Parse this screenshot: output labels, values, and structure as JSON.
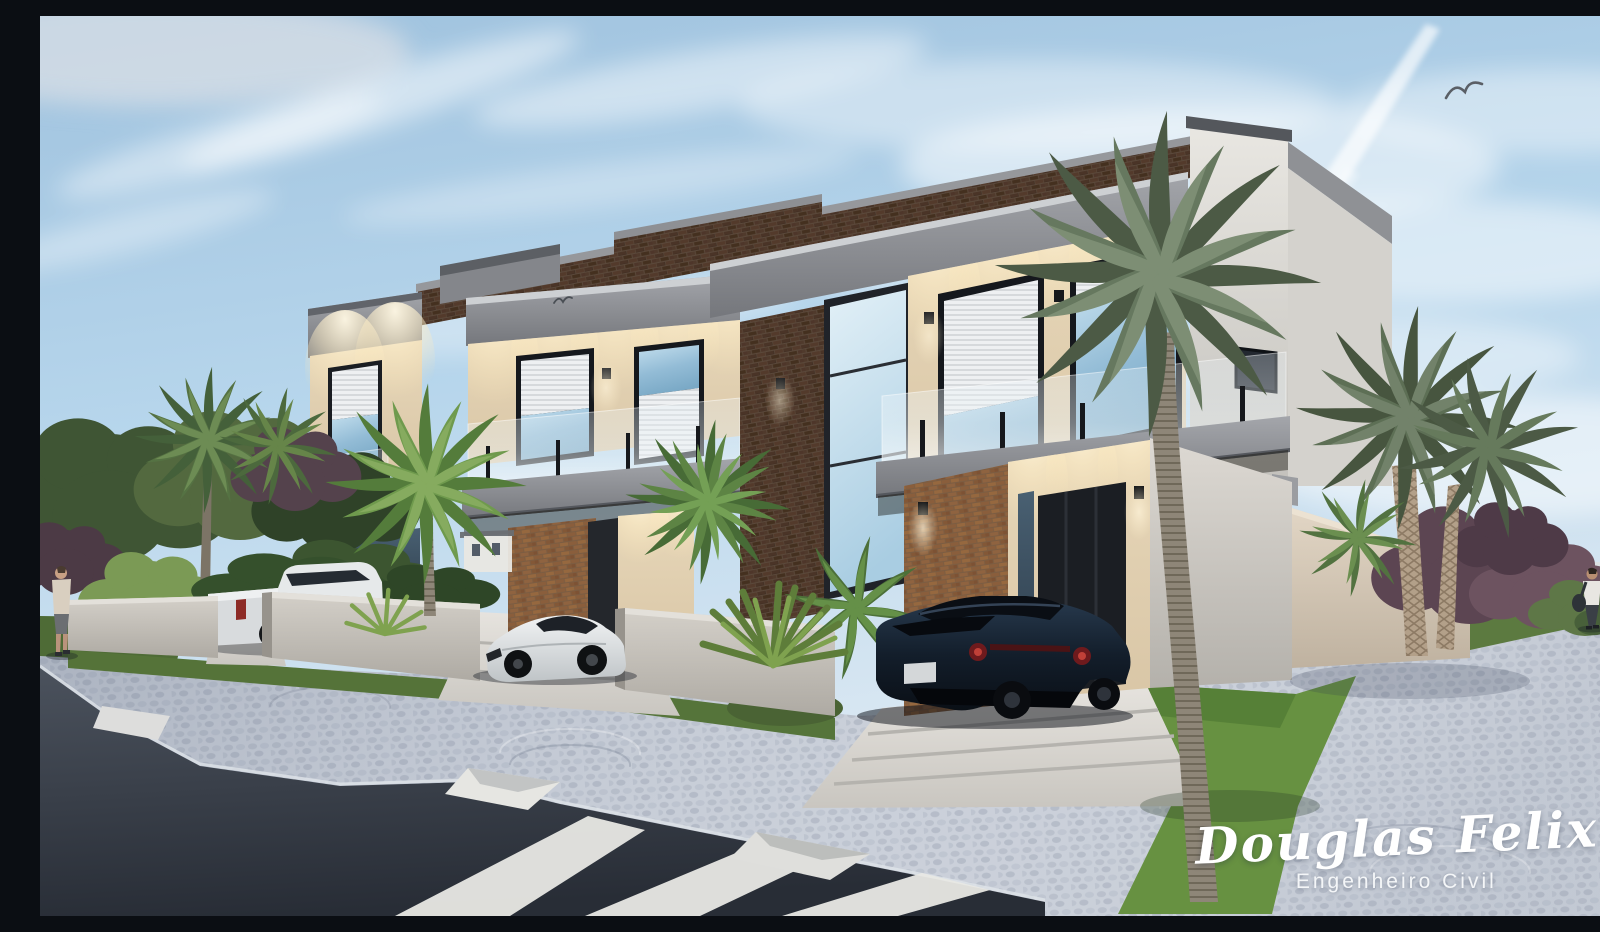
{
  "watermark": {
    "name": "Douglas Felix",
    "title": "Engenheiro Civil"
  },
  "scene": {
    "type": "exterior architectural 3D rendering",
    "subject": "row of three modern two-story townhouses with brick upper facade, glass balconies and lit soffits",
    "sky": [
      "blue sky",
      "wispy clouds",
      "jet contrail",
      "two birds"
    ],
    "vehicles": [
      {
        "type": "pickup-truck",
        "color": "white"
      },
      {
        "type": "sports-car",
        "color": "white"
      },
      {
        "type": "sports-car",
        "color": "dark navy"
      }
    ],
    "people": [
      {
        "position": "left sidewalk",
        "detail": "man in beige shirt and shorts"
      },
      {
        "position": "right sidewalk",
        "detail": "man in white shirt with shoulder bag"
      }
    ],
    "vegetation": [
      "tall palm tree on front lawn",
      "paired palms at right",
      "green shrubs",
      "purple-leaf trees",
      "yucca plants",
      "lawns"
    ],
    "street": [
      "cobblestone sidewalk",
      "asphalt road",
      "zebra crosswalk",
      "curb ramps",
      "low concrete fence walls",
      "concrete driveways"
    ]
  },
  "palette": {
    "sky": "#b7d6ec",
    "brick": "#4e382a",
    "warm_brick": "#8a5e3c",
    "concrete_fascia": "#8f9196",
    "lit_soffit": "#f1e5cc",
    "glass": "#9cc2da",
    "white_wall": "#dcd9d3",
    "grass": "#5f8142",
    "lawn": "#679141",
    "cobblestone": "#c8ced8",
    "asphalt": "#39404b",
    "signature": "#ffffff"
  }
}
